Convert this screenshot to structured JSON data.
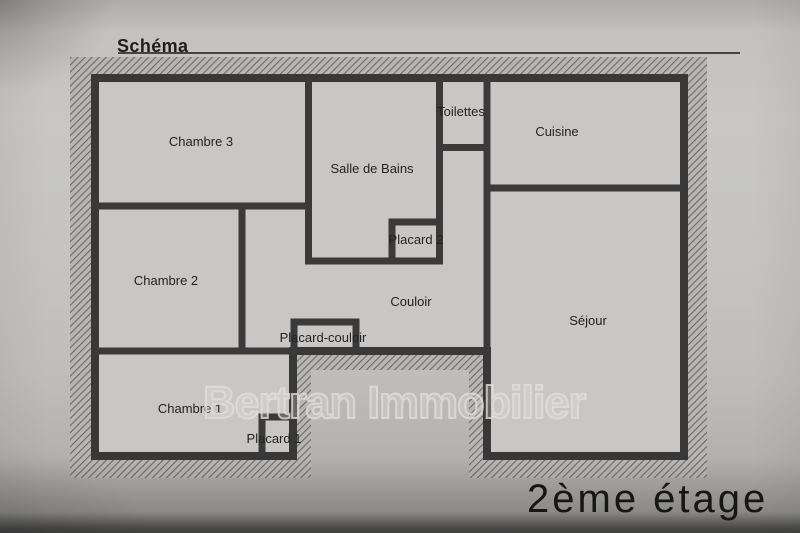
{
  "document": {
    "title": "Schéma",
    "floor_label": "2ème étage",
    "watermark": "Bertran Immobilier"
  },
  "plan": {
    "rooms": [
      {
        "id": "chambre-3",
        "label": "Chambre 3"
      },
      {
        "id": "chambre-2",
        "label": "Chambre 2"
      },
      {
        "id": "chambre-1",
        "label": "Chambre 1"
      },
      {
        "id": "salle-de-bains",
        "label": "Salle de Bains"
      },
      {
        "id": "toilettes",
        "label": "Toilettes"
      },
      {
        "id": "placard-2",
        "label": "Placard 2"
      },
      {
        "id": "cuisine",
        "label": "Cuisine"
      },
      {
        "id": "couloir",
        "label": "Couloir"
      },
      {
        "id": "placard-couloir",
        "label": "Placard-couloir"
      },
      {
        "id": "sejour",
        "label": "Séjour"
      },
      {
        "id": "placard-1",
        "label": "Placard 1"
      }
    ],
    "colors": {
      "wall": "#383838",
      "room_fill": "#c8c7c5",
      "hatch_background": "#b7b6b4",
      "hatch_line": "#6e6d6b",
      "page_background": "#c2c1bf",
      "label_text": "#232323"
    }
  }
}
